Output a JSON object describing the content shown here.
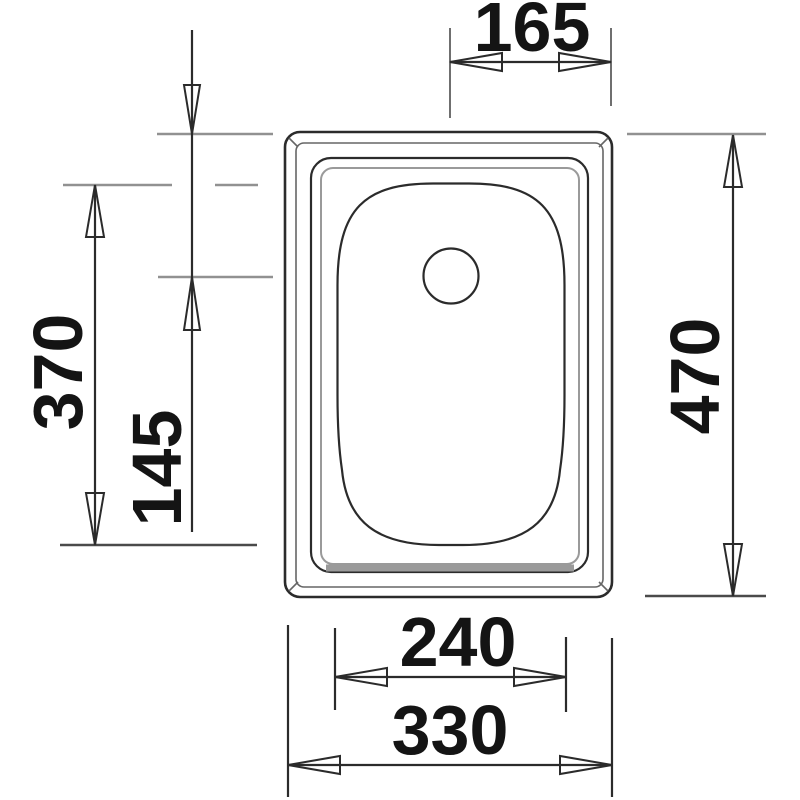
{
  "colors": {
    "line-color": "#2b2b2b",
    "ref-line-color": "#919191",
    "ref-dark-color": "#4a4a4a",
    "label-color": "#141414",
    "bg-color": "#ffffff"
  },
  "drawing": {
    "name": "Sink top-view technical drawing with dimensions",
    "labels": {
      "top": "165",
      "left_outer": "370",
      "left_inner": "145",
      "right": "470",
      "bottom_inner": "240",
      "bottom_outer": "330"
    }
  }
}
